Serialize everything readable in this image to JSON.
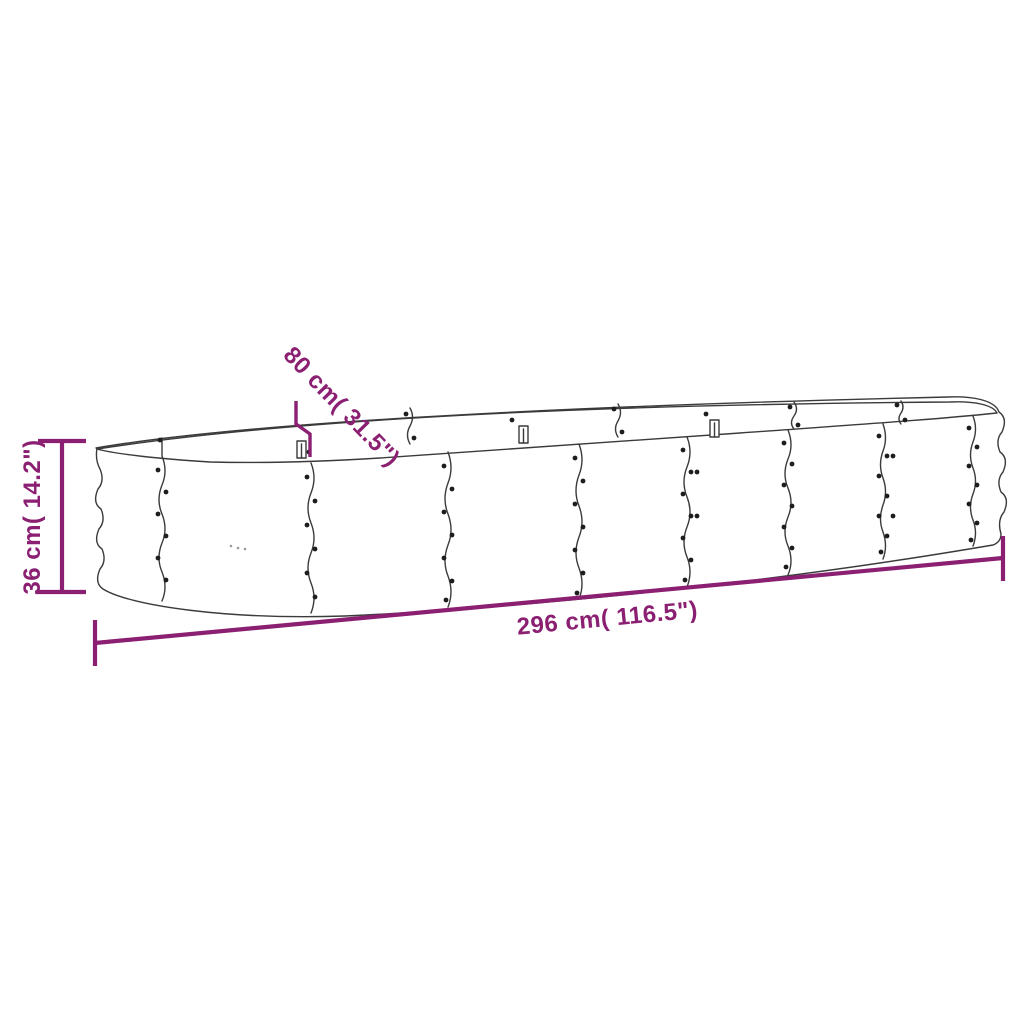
{
  "diagram": {
    "type": "product-dimension-drawing",
    "product_name": "oval-corrugated-raised-garden-bed",
    "background_color": "#ffffff",
    "line_color": "#3b3b3b",
    "accent_color": "#8B1F72",
    "dimensions": {
      "height": {
        "value_cm": "36",
        "value_inch": "14.2",
        "label": "36 cm( 14.2\")"
      },
      "width": {
        "value_cm": "80",
        "value_inch": "31.5",
        "label": "80 cm( 31.5\")"
      },
      "length": {
        "value_cm": "296",
        "value_inch": "116.5",
        "label": "296 cm( 116.5\")"
      }
    }
  }
}
